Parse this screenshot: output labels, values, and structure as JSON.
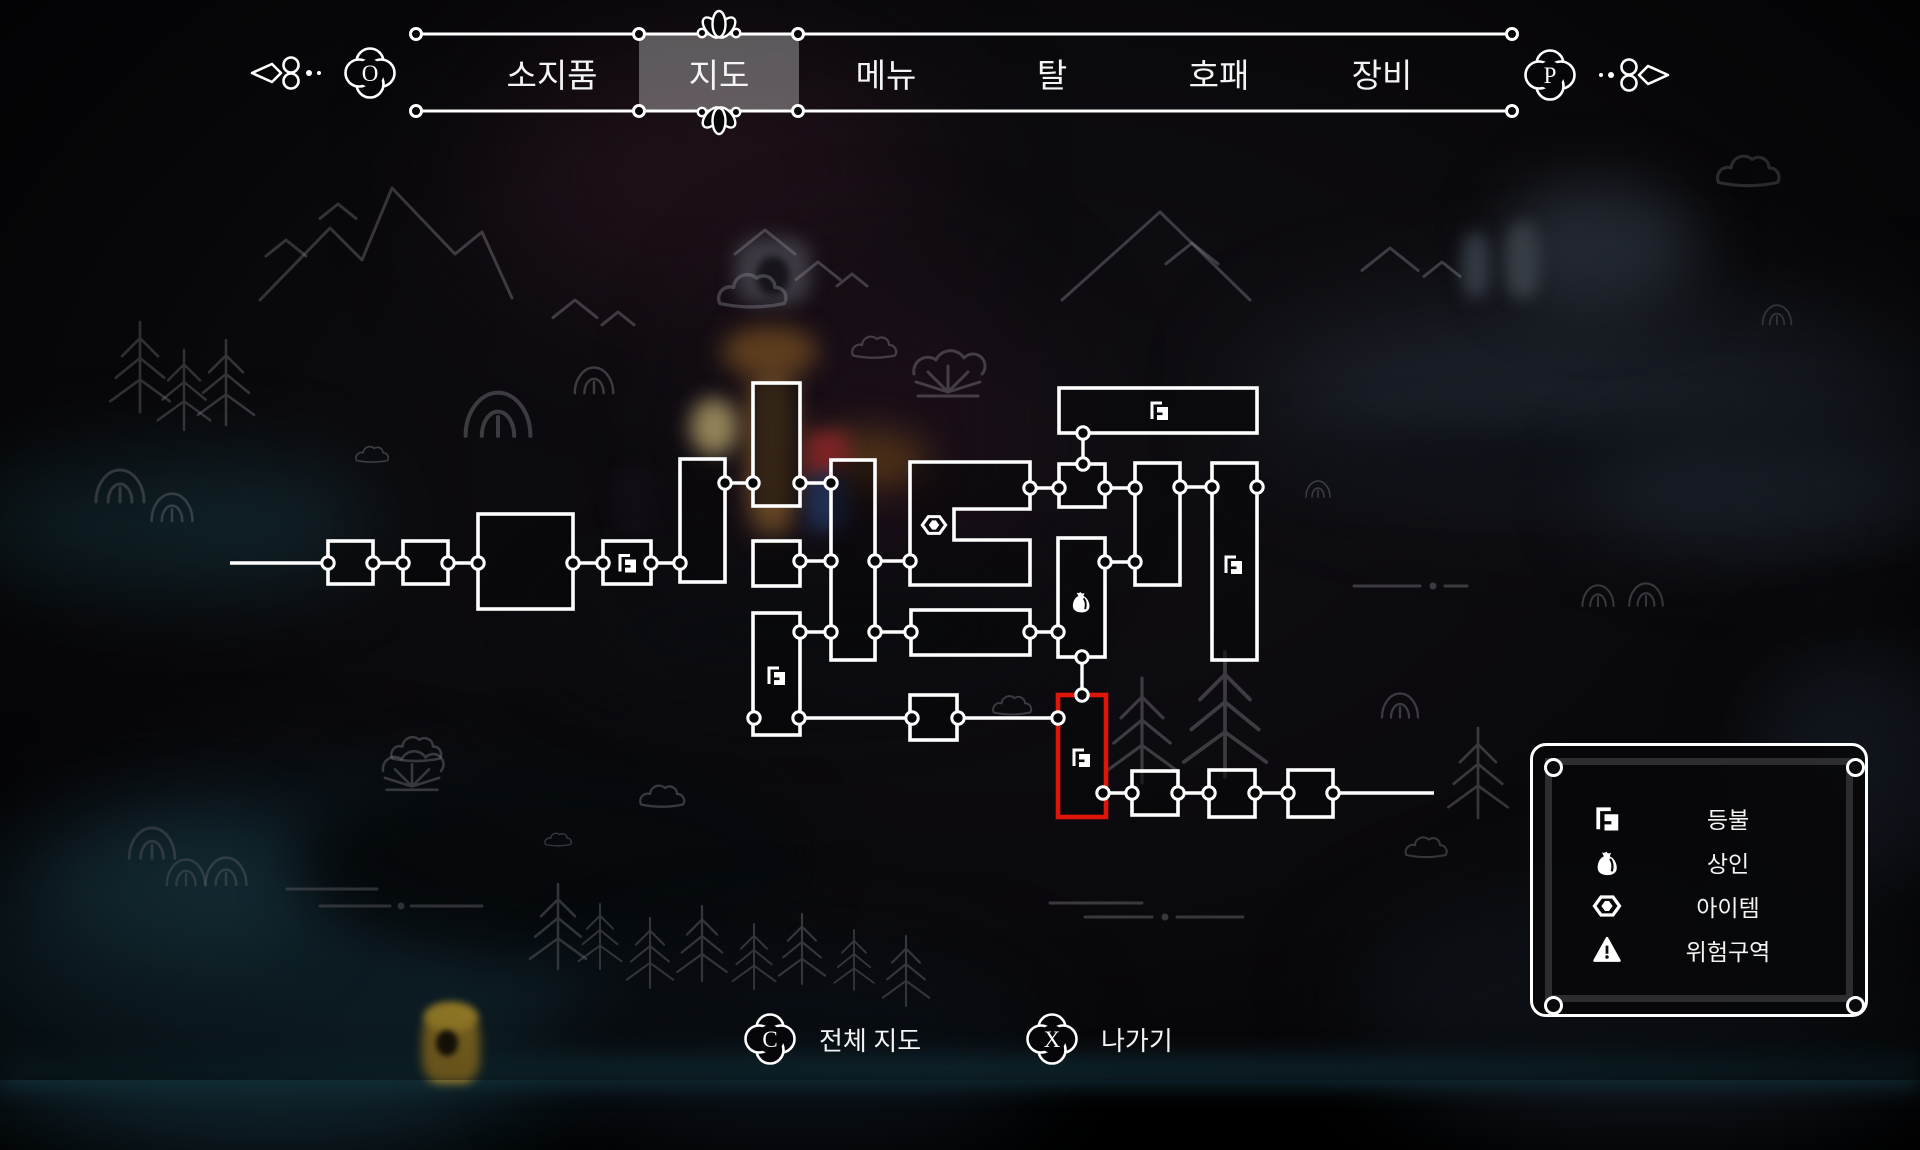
{
  "nav": {
    "left_key": "O",
    "right_key": "P",
    "tabs": [
      {
        "label": "소지품",
        "x": 552,
        "selected": false
      },
      {
        "label": "지도",
        "x": 719,
        "selected": true
      },
      {
        "label": "메뉴",
        "x": 886,
        "selected": false
      },
      {
        "label": "탈",
        "x": 1052,
        "selected": false
      },
      {
        "label": "호패",
        "x": 1219,
        "selected": false
      },
      {
        "label": "장비",
        "x": 1382,
        "selected": false
      }
    ]
  },
  "map": {
    "rooms": [
      {
        "id": "room-1",
        "x": 328,
        "y": 541,
        "w": 45,
        "h": 43
      },
      {
        "id": "room-2",
        "x": 403,
        "y": 541,
        "w": 45,
        "h": 43
      },
      {
        "id": "room-3",
        "x": 478,
        "y": 514,
        "w": 95,
        "h": 95
      },
      {
        "id": "room-4",
        "x": 603,
        "y": 541,
        "w": 48,
        "h": 43,
        "icon": "lantern"
      },
      {
        "id": "room-5",
        "x": 680,
        "y": 459,
        "w": 45,
        "h": 123
      },
      {
        "id": "room-6",
        "x": 753,
        "y": 383,
        "w": 47,
        "h": 123
      },
      {
        "id": "room-7",
        "x": 753,
        "y": 541,
        "w": 47,
        "h": 45
      },
      {
        "id": "room-8",
        "x": 753,
        "y": 613,
        "w": 47,
        "h": 122,
        "icon": "lantern",
        "icon_x": 776,
        "icon_y": 675
      },
      {
        "id": "room-9",
        "x": 831,
        "y": 460,
        "w": 44,
        "h": 200
      },
      {
        "id": "room-10",
        "path": "M910,462 H1030 V509 H954 V540 H1030 V585 H910 Z",
        "icon": "gem",
        "icon_x": 934,
        "icon_y": 525
      },
      {
        "id": "room-11",
        "x": 911,
        "y": 610,
        "w": 119,
        "h": 45
      },
      {
        "id": "room-12",
        "x": 1059,
        "y": 388,
        "w": 198,
        "h": 45,
        "icon": "lantern",
        "icon_x": 1159,
        "icon_y": 410
      },
      {
        "id": "room-13",
        "x": 1059,
        "y": 464,
        "w": 46,
        "h": 43
      },
      {
        "id": "room-14",
        "x": 1058,
        "y": 538,
        "w": 47,
        "h": 119,
        "icon": "merchant",
        "icon_x": 1081,
        "icon_y": 601
      },
      {
        "id": "room-15",
        "x": 1135,
        "y": 463,
        "w": 45,
        "h": 122
      },
      {
        "id": "room-16",
        "x": 1212,
        "y": 463,
        "w": 45,
        "h": 197,
        "icon": "lantern",
        "icon_x": 1233,
        "icon_y": 564
      },
      {
        "id": "room-17",
        "x": 1058,
        "y": 695,
        "w": 48,
        "h": 122,
        "icon": "lantern",
        "icon_x": 1081,
        "icon_y": 757,
        "highlight": true
      },
      {
        "id": "room-18",
        "x": 910,
        "y": 695,
        "w": 47,
        "h": 45
      },
      {
        "id": "room-19",
        "x": 1132,
        "y": 771,
        "w": 46,
        "h": 44
      },
      {
        "id": "room-20",
        "x": 1209,
        "y": 770,
        "w": 46,
        "h": 47
      },
      {
        "id": "room-21",
        "x": 1288,
        "y": 770,
        "w": 45,
        "h": 47
      }
    ],
    "connectors": [
      [
        373,
        563,
        403,
        563
      ],
      [
        448,
        563,
        478,
        563
      ],
      [
        573,
        563,
        603,
        563
      ],
      [
        651,
        563,
        680,
        563
      ],
      [
        725,
        483,
        753,
        483
      ],
      [
        800,
        483,
        831,
        483
      ],
      [
        800,
        561,
        831,
        561
      ],
      [
        875,
        561,
        910,
        561
      ],
      [
        1030,
        488,
        1059,
        488
      ],
      [
        1105,
        488,
        1135,
        488
      ],
      [
        1180,
        487,
        1212,
        487
      ],
      [
        800,
        632,
        831,
        632
      ],
      [
        875,
        632,
        911,
        632
      ],
      [
        1030,
        632,
        1058,
        632
      ],
      [
        1105,
        562,
        1135,
        562
      ],
      [
        1083,
        433,
        1083,
        464
      ],
      [
        1082,
        657,
        1082,
        695
      ],
      [
        799,
        718,
        912,
        718
      ],
      [
        958,
        718,
        1058,
        718
      ],
      [
        1103,
        793,
        1132,
        793
      ],
      [
        1178,
        793,
        1209,
        793
      ],
      [
        1255,
        793,
        1288,
        793
      ]
    ],
    "corridor_lines": [
      [
        230,
        563,
        328,
        563
      ],
      [
        1333,
        793,
        1434,
        793
      ]
    ],
    "extra_nodes": [
      [
        328,
        563
      ],
      [
        754,
        718
      ],
      [
        1257,
        487
      ],
      [
        1333,
        793
      ]
    ]
  },
  "legend": {
    "rows": [
      {
        "icon": "lantern",
        "label": "등불"
      },
      {
        "icon": "merchant",
        "label": "상인"
      },
      {
        "icon": "gem",
        "label": "아이템"
      },
      {
        "icon": "danger",
        "label": "위험구역"
      }
    ]
  },
  "prompts": [
    {
      "key": "C",
      "label": "전체 지도",
      "x": 770
    },
    {
      "key": "X",
      "label": "나가기",
      "x": 1052
    }
  ],
  "colors": {
    "accent_red": "#e0150a",
    "white": "#ffffff",
    "text": "#f4f4f4",
    "tab_highlight": "rgba(255,255,255,0.32)"
  }
}
